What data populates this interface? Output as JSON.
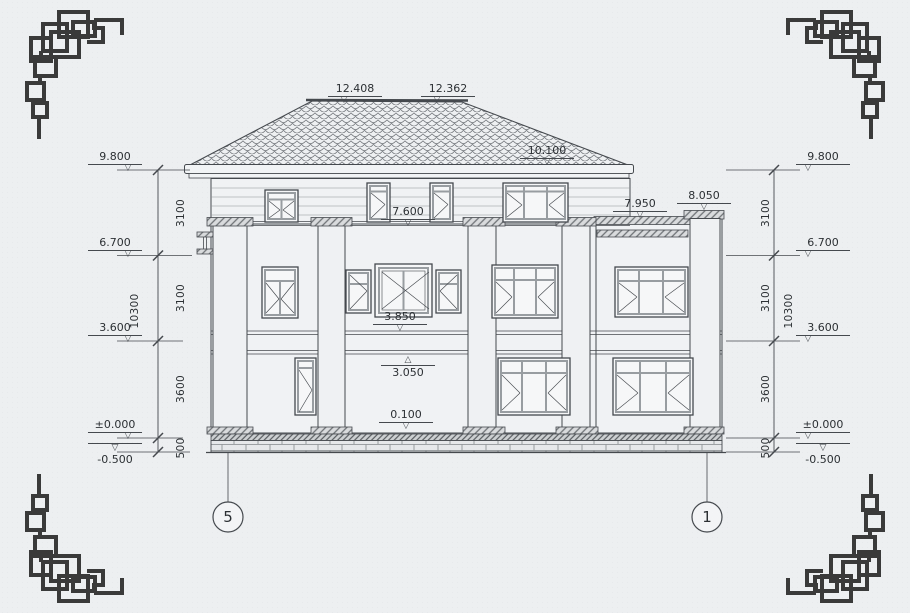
{
  "page": {
    "background": "#edeff1",
    "line_color": "#45494e",
    "ornament_color": "#3a3a3a"
  },
  "icons": {
    "level_down": "▽",
    "level_up": "△"
  },
  "elevation_levels": [
    {
      "label": "9.800"
    },
    {
      "label": "6.700"
    },
    {
      "label": "3.600"
    },
    {
      "label": "±0.000"
    },
    {
      "label": "-0.500"
    }
  ],
  "dim_segments": [
    {
      "label": "3100"
    },
    {
      "label": "3100"
    },
    {
      "label": "3600"
    },
    {
      "label": "500"
    }
  ],
  "dim_overall": {
    "label": "10300"
  },
  "roof_markers": {
    "ridge_left": {
      "label": "12.408"
    },
    "ridge_right": {
      "label": "12.362"
    },
    "slope": {
      "label": "10.100"
    }
  },
  "facade_markers": {
    "terrace": {
      "label": "7.600"
    },
    "wing_parapet": {
      "label": "7.950"
    },
    "wing_pilaster_cap": {
      "label": "8.050"
    },
    "floor_band_top": {
      "label": "3.850"
    },
    "floor_band_soffit": {
      "label": "3.050"
    },
    "plinth": {
      "label": "0.100"
    }
  },
  "axis_bubbles": {
    "left": {
      "label": "5"
    },
    "right": {
      "label": "1"
    }
  }
}
